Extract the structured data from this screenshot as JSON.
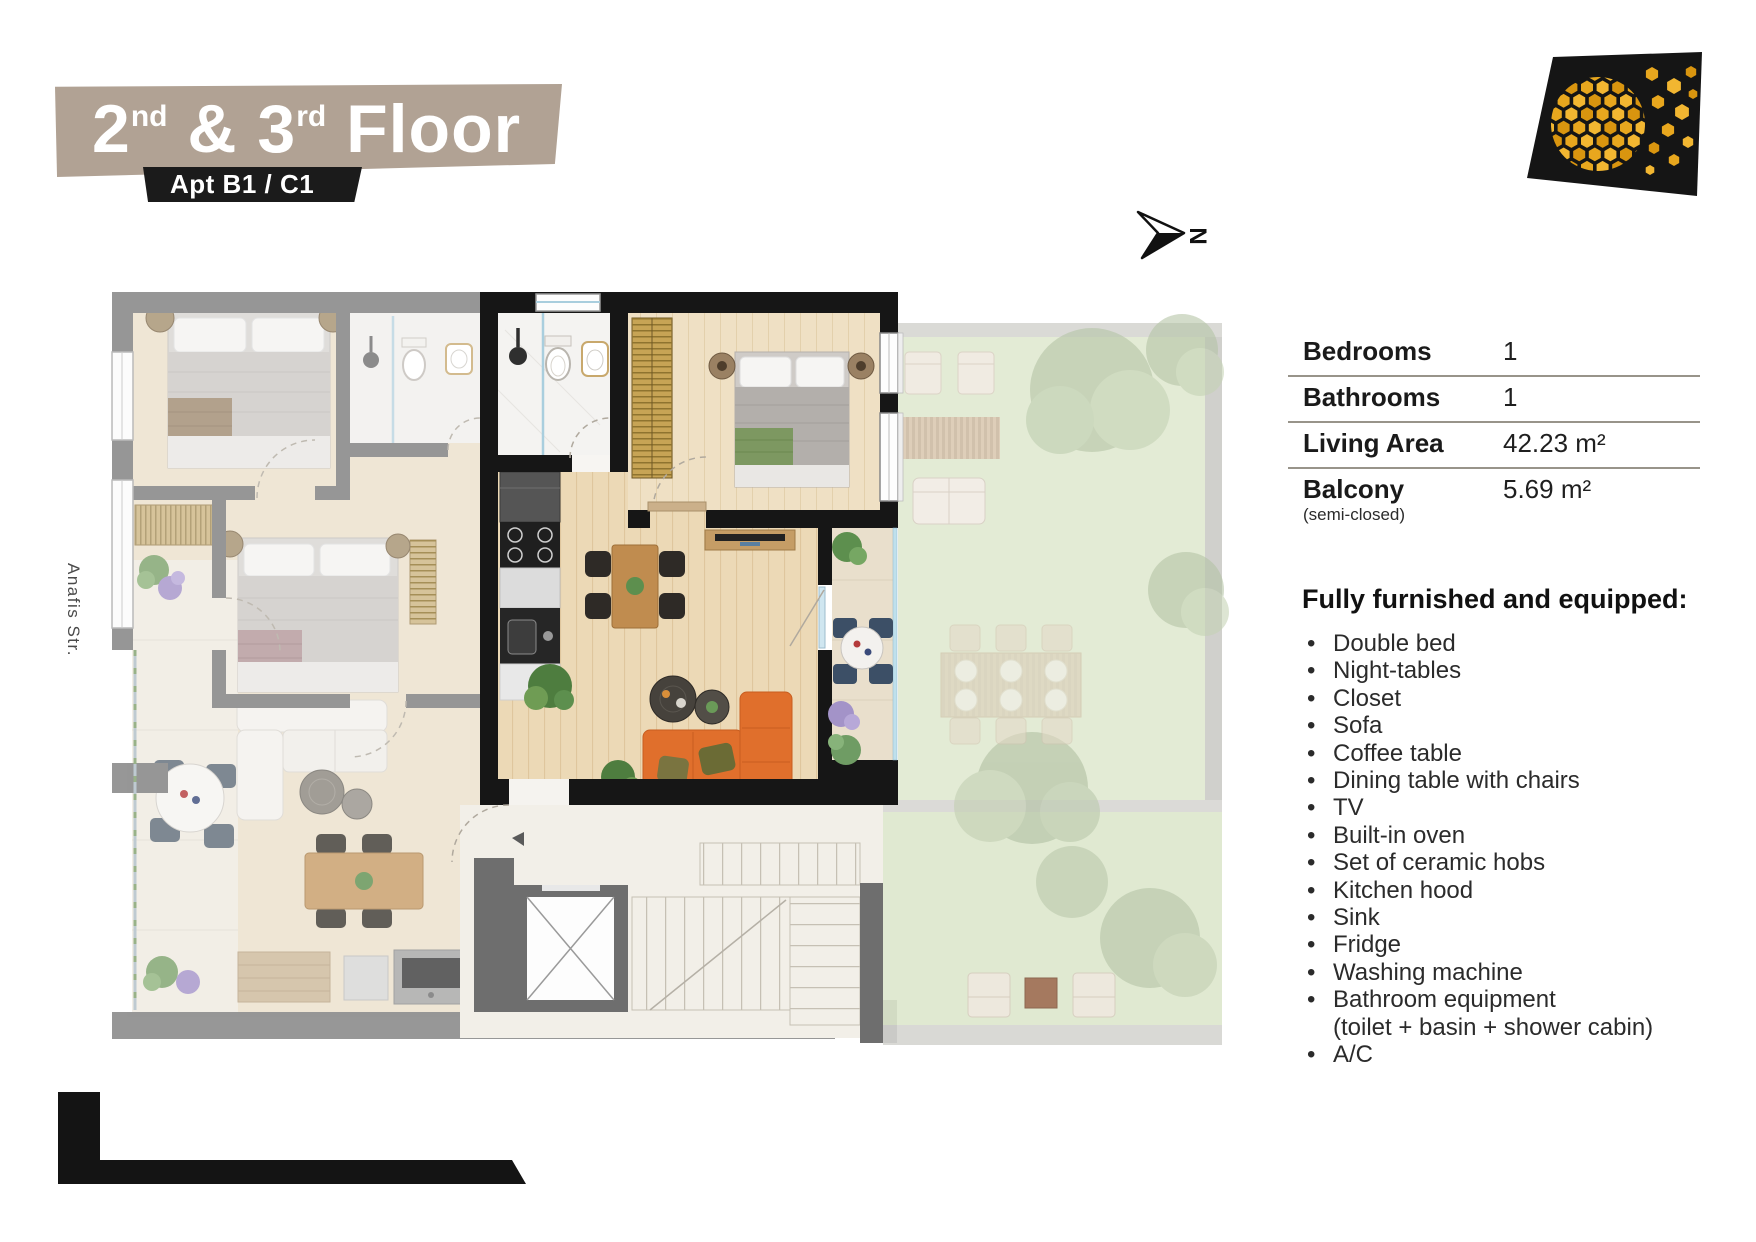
{
  "header": {
    "floor_title": {
      "num1": "2",
      "sup1": "nd",
      "sep": " & ",
      "num2": "3",
      "sup2": "rd",
      "word": " Floor"
    },
    "apt_label": "Apt B1 / C1"
  },
  "compass": {
    "north_label": "N"
  },
  "plan": {
    "street_label": "Anafis Str."
  },
  "specs": {
    "rows": [
      {
        "label": "Bedrooms",
        "sub": "",
        "value": "1"
      },
      {
        "label": "Bathrooms",
        "sub": "",
        "value": "1"
      },
      {
        "label": "Living Area",
        "sub": "",
        "value": "42.23 m²"
      },
      {
        "label": "Balcony",
        "sub": "(semi-closed)",
        "value": "5.69 m²"
      }
    ]
  },
  "features": {
    "heading": "Fully furnished and equipped:",
    "items": [
      {
        "text": "Double bed"
      },
      {
        "text": "Night-tables"
      },
      {
        "text": "Closet"
      },
      {
        "text": "Sofa"
      },
      {
        "text": "Coffee table"
      },
      {
        "text": "Dining table with chairs"
      },
      {
        "text": "TV"
      },
      {
        "text": "Built-in oven"
      },
      {
        "text": "Set of ceramic hobs"
      },
      {
        "text": "Kitchen hood"
      },
      {
        "text": "Sink"
      },
      {
        "text": "Fridge"
      },
      {
        "text": "Washing machine"
      },
      {
        "text": "Bathroom equipment",
        "sub": "(toilet + basin + shower cabin)"
      },
      {
        "text": "A/C"
      }
    ]
  },
  "colors": {
    "banner_tan": "#b1a294",
    "banner_black": "#1b1b1b",
    "logo_gold": "#e8a71e",
    "sofa_orange": "#e06f2c",
    "wall_black": "#161616",
    "wall_gray": "#7d7d7d",
    "grass_green": "#e0e9d1",
    "wood_floor": "#ecd9b6"
  }
}
